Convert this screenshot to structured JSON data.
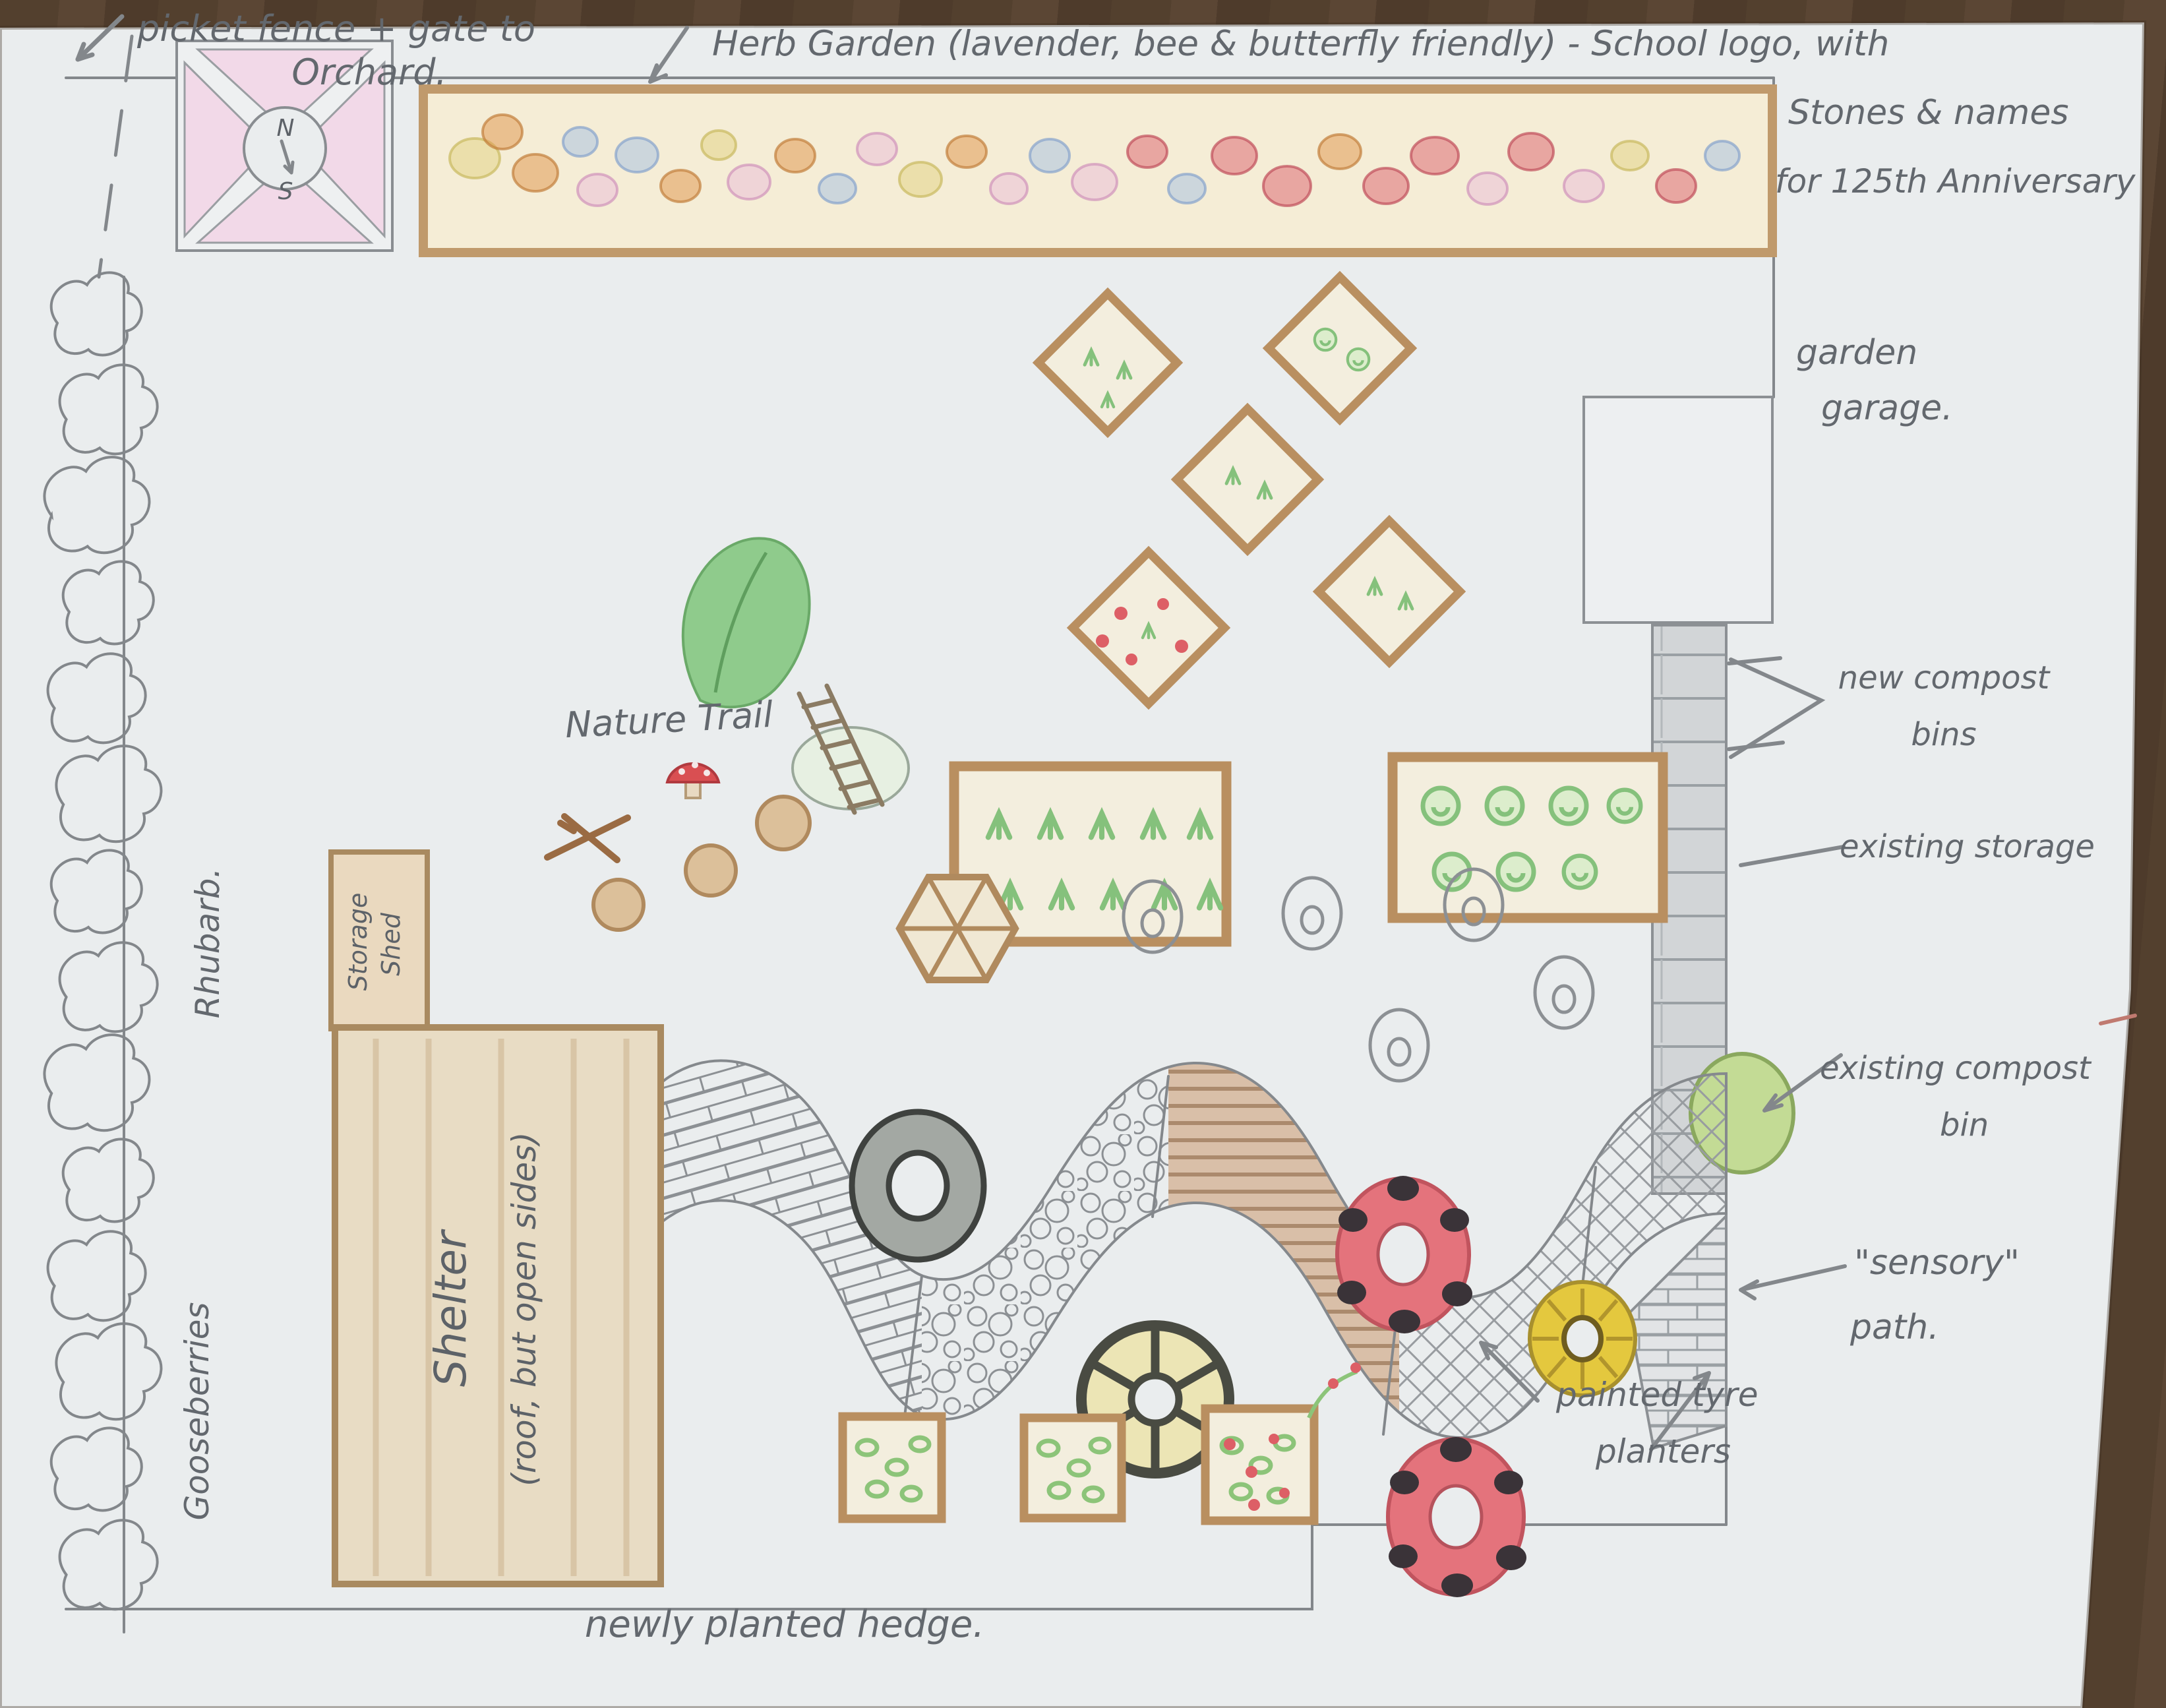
{
  "title": "Hand-drawn school garden design plan",
  "labels": {
    "picket_fence": [
      "picket fence + gate to",
      "Orchard."
    ],
    "herb_garden": "Herb Garden (lavender, bee & butterfly friendly) - School logo, with",
    "anniversary": [
      "Stones & names",
      "for 125th Anniversary"
    ],
    "garden_garage": [
      "garden",
      "garage."
    ],
    "new_compost": [
      "new compost",
      "bins"
    ],
    "existing_storage": "existing storage",
    "existing_compost": [
      "existing compost",
      "bin"
    ],
    "sensory_path": [
      "\"sensory\"",
      "path."
    ],
    "painted_tyre": [
      "painted tyre",
      "planters"
    ],
    "hedge": "newly planted hedge.",
    "nature_trail": "Nature Trail",
    "shelter": [
      "Shelter",
      "(roof, but open sides)"
    ],
    "storage_shed": [
      "Storage",
      "Shed"
    ],
    "rhubarb": "Rhubarb.",
    "gooseberries": "Gooseberries",
    "compass": [
      "N",
      "S"
    ]
  },
  "colors": {
    "paper": "#eaedee",
    "wood": "#53402e",
    "pencil": "#83878b",
    "handwriting": "#63686e",
    "pink_bed": "#f2d9e8",
    "bed_frame": "#b98f60",
    "bed_fill": "#f3eede",
    "plant_green": "#85c17c",
    "leaf_green": "#8fcb8c",
    "ladybird_red": "#e4737c",
    "spot_black": "#3a3338",
    "sunflower_yellow": "#e4c83e",
    "wheel_yellow": "#ece5b5",
    "tyre_grey": "#a3a8a3",
    "compost_green": "#c3db95",
    "brick_grey": "#d2d5d7",
    "stripe_brown": "#d9bfa8"
  }
}
